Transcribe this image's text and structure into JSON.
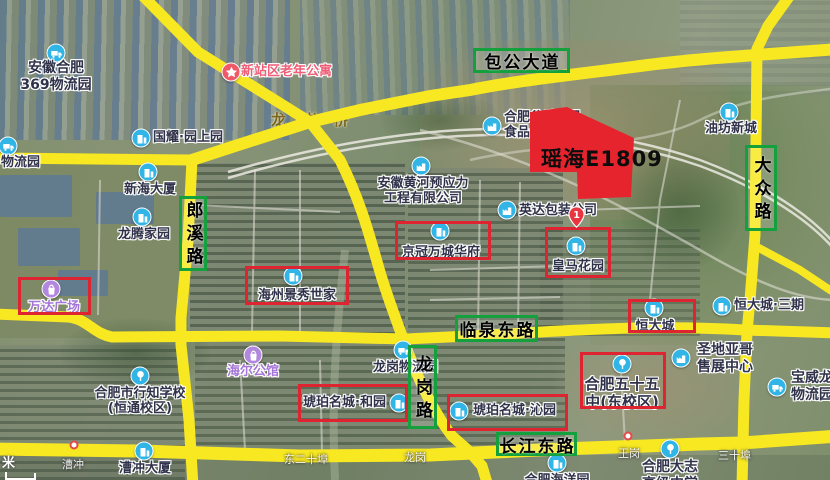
{
  "map": {
    "plot": {
      "label": "瑶海E1809",
      "fill": "#e5242e",
      "points": "530,112 567,107 634,138 631,197 578,199 577,172 530,172"
    },
    "scale_unit": "米",
    "bridge_label": "龙岗桥",
    "marker_pin": {
      "label": "1",
      "x": 568,
      "y": 206
    },
    "colors": {
      "road": "#f7e821",
      "road_label_border": "#14a03c",
      "highlight_box": "#de2430",
      "text_dark": "#30324a",
      "text_purple": "#a476d6",
      "text_pink": "#ef5d76",
      "icon_blue": "#31b4e6",
      "icon_purple": "#b288de",
      "icon_red": "#f05a68"
    },
    "road_labels": [
      {
        "id": "baogong-avenue",
        "text": "包公大道",
        "x": 473,
        "y": 48,
        "w": 97,
        "h": 25,
        "vertical": false
      },
      {
        "id": "langxi-road",
        "text": "郎溪路",
        "x": 179,
        "y": 196,
        "w": 28,
        "h": 75,
        "vertical": true
      },
      {
        "id": "dazhong-road",
        "text": "大众路",
        "x": 745,
        "y": 145,
        "w": 32,
        "h": 86,
        "vertical": true
      },
      {
        "id": "linquan-east-road",
        "text": "临泉东路",
        "x": 455,
        "y": 315,
        "w": 83,
        "h": 27,
        "vertical": false
      },
      {
        "id": "longgang-road",
        "text": "龙岗路",
        "x": 408,
        "y": 345,
        "w": 29,
        "h": 84,
        "vertical": true
      },
      {
        "id": "changjiang-east-road",
        "text": "长江东路",
        "x": 496,
        "y": 432,
        "w": 81,
        "h": 24,
        "vertical": false
      }
    ],
    "highlight_boxes": [
      {
        "id": "box-wanda",
        "x": 18,
        "y": 277,
        "w": 73,
        "h": 38
      },
      {
        "id": "box-haizhou",
        "x": 245,
        "y": 266,
        "w": 104,
        "h": 39
      },
      {
        "id": "box-jingguan",
        "x": 395,
        "y": 221,
        "w": 96,
        "h": 39
      },
      {
        "id": "box-huangma",
        "x": 545,
        "y": 227,
        "w": 66,
        "h": 51
      },
      {
        "id": "box-hengdacheng",
        "x": 628,
        "y": 299,
        "w": 68,
        "h": 34
      },
      {
        "id": "box-hupo-heyuan",
        "x": 298,
        "y": 384,
        "w": 110,
        "h": 38
      },
      {
        "id": "box-hupo-qinyuan",
        "x": 447,
        "y": 394,
        "w": 121,
        "h": 37
      },
      {
        "id": "box-no55-school",
        "x": 580,
        "y": 352,
        "w": 86,
        "h": 57
      }
    ],
    "pois": [
      {
        "id": "anhui-369-logistics",
        "lines": [
          "安徽合肥",
          "369物流园"
        ],
        "color": "dark",
        "size": 14,
        "align": "center",
        "lx": 56,
        "ly": 60,
        "icon": "truck",
        "icolor": "blue",
        "ix": 56,
        "iy": 53
      },
      {
        "id": "xinzhan-elderly-apartment",
        "lines": [
          "新站区老年公寓"
        ],
        "color": "pink",
        "size": 13,
        "align": "left",
        "lx": 241,
        "ly": 64,
        "icon": "star",
        "icolor": "red",
        "ix": 231,
        "iy": 72
      },
      {
        "id": "guoyao-yuanshangyuan",
        "lines": [
          "国耀·园上园"
        ],
        "color": "dark",
        "size": 13,
        "align": "left",
        "lx": 153,
        "ly": 130,
        "icon": "building",
        "icolor": "blue",
        "ix": 141,
        "iy": 138
      },
      {
        "id": "logistics-park-left-edge",
        "lines": [
          "物流园"
        ],
        "color": "dark",
        "size": 13,
        "align": "left",
        "lx": 1,
        "ly": 155,
        "icon": "truck",
        "icolor": "blue",
        "ix": 8,
        "iy": 146
      },
      {
        "id": "xinhai-building",
        "lines": [
          "新海大厦"
        ],
        "color": "dark",
        "size": 13,
        "align": "center",
        "lx": 150,
        "ly": 182,
        "icon": "building",
        "icolor": "blue",
        "ix": 148,
        "iy": 172
      },
      {
        "id": "longteng-homeland",
        "lines": [
          "龙腾家园"
        ],
        "color": "dark",
        "size": 13,
        "align": "center",
        "lx": 144,
        "ly": 227,
        "icon": "building",
        "icolor": "blue",
        "ix": 142,
        "iy": 217
      },
      {
        "id": "anhui-huanghe-prestress",
        "lines": [
          "安徽黄河预应力",
          "工程有限公司"
        ],
        "color": "dark",
        "size": 13,
        "align": "center",
        "lx": 423,
        "ly": 176,
        "icon": "factory",
        "icolor": "blue",
        "ix": 421,
        "iy": 166
      },
      {
        "id": "hefei-gushi-food",
        "lines": [
          "合肥谷香食品",
          "食品公司"
        ],
        "color": "dark",
        "size": 13,
        "align": "left",
        "lx": 504,
        "ly": 110,
        "icon": "factory",
        "icolor": "blue",
        "ix": 492,
        "iy": 126
      },
      {
        "id": "yingda-packaging",
        "lines": [
          "英达包装公司"
        ],
        "color": "dark",
        "size": 13,
        "align": "left",
        "lx": 519,
        "ly": 203,
        "icon": "factory",
        "icolor": "blue",
        "ix": 507,
        "iy": 210
      },
      {
        "id": "youfang-xincheng",
        "lines": [
          "油坊新城"
        ],
        "color": "dark",
        "size": 13,
        "align": "center",
        "lx": 731,
        "ly": 121,
        "icon": "building",
        "icolor": "blue",
        "ix": 729,
        "iy": 112
      },
      {
        "id": "hengdacheng-phase3",
        "lines": [
          "恒大城·三期"
        ],
        "color": "dark",
        "size": 13,
        "align": "left",
        "lx": 734,
        "ly": 298,
        "icon": "building",
        "icolor": "blue",
        "ix": 722,
        "iy": 306
      },
      {
        "id": "huangma-garden",
        "lines": [
          "皇马花园"
        ],
        "color": "dark",
        "size": 13,
        "align": "center",
        "lx": 578,
        "ly": 259,
        "icon": "building",
        "icolor": "blue",
        "ix": 576,
        "iy": 246
      },
      {
        "id": "jingguan-wancheng-huafu",
        "lines": [
          "京冠万城华府"
        ],
        "color": "dark",
        "size": 13,
        "align": "center",
        "lx": 441,
        "ly": 245,
        "icon": "building",
        "icolor": "blue",
        "ix": 440,
        "iy": 231
      },
      {
        "id": "haizhou-jingxiu-shijia",
        "lines": [
          "海州景秀世家"
        ],
        "color": "dark",
        "size": 13,
        "align": "center",
        "lx": 297,
        "ly": 288,
        "icon": "building",
        "icolor": "blue",
        "ix": 293,
        "iy": 276
      },
      {
        "id": "wanda-plaza",
        "lines": [
          "万达广场"
        ],
        "color": "purple",
        "size": 13,
        "align": "center",
        "lx": 54,
        "ly": 300,
        "icon": "bag",
        "icolor": "purple",
        "ix": 51,
        "iy": 289
      },
      {
        "id": "hengdacheng",
        "lines": [
          "恒大城"
        ],
        "color": "dark",
        "size": 13,
        "align": "center",
        "lx": 655,
        "ly": 319,
        "icon": "building",
        "icolor": "blue",
        "ix": 654,
        "iy": 308
      },
      {
        "id": "hupo-mingcheng-heyuan",
        "lines": [
          "琥珀名城·和园"
        ],
        "color": "dark",
        "size": 13,
        "align": "left",
        "lx": 303,
        "ly": 395,
        "icon": "building",
        "icolor": "blue",
        "ix": 399,
        "iy": 403
      },
      {
        "id": "hupo-mingcheng-qinyuan",
        "lines": [
          "琥珀名城·沁园"
        ],
        "color": "dark",
        "size": 13,
        "align": "left",
        "lx": 473,
        "ly": 403,
        "icon": "building",
        "icolor": "blue",
        "ix": 459,
        "iy": 411
      },
      {
        "id": "hefei-no55-middle-school",
        "lines": [
          "合肥五十五",
          "中(东校区)"
        ],
        "color": "dark",
        "size": 15,
        "align": "center",
        "lx": 622,
        "ly": 376,
        "icon": "school",
        "icolor": "blue",
        "ix": 622,
        "iy": 364
      },
      {
        "id": "shengdiyage-sales-center",
        "lines": [
          "圣地亚哥",
          "售展中心"
        ],
        "color": "dark",
        "size": 14,
        "align": "left",
        "lx": 697,
        "ly": 342,
        "icon": "factory",
        "icolor": "blue",
        "ix": 681,
        "iy": 358
      },
      {
        "id": "baoweilong-logistics",
        "lines": [
          "宝威龙志",
          "物流园"
        ],
        "color": "dark",
        "size": 14,
        "align": "left",
        "lx": 791,
        "ly": 370,
        "icon": "truck",
        "icolor": "blue",
        "ix": 777,
        "iy": 387
      },
      {
        "id": "xingzhi-school",
        "lines": [
          "合肥市行知学校",
          "(恒通校区)"
        ],
        "color": "dark",
        "size": 13,
        "align": "center",
        "lx": 140,
        "ly": 386,
        "icon": "school",
        "icolor": "blue",
        "ix": 140,
        "iy": 376
      },
      {
        "id": "haier-gongguan",
        "lines": [
          "海尔公馆"
        ],
        "color": "purple",
        "size": 13,
        "align": "center",
        "lx": 253,
        "ly": 364,
        "icon": "bag",
        "icolor": "purple",
        "ix": 253,
        "iy": 355
      },
      {
        "id": "longgang-logistics",
        "lines": [
          "龙岗物流园"
        ],
        "color": "dark",
        "size": 13,
        "align": "left",
        "lx": 373,
        "ly": 360,
        "icon": "truck",
        "icolor": "blue",
        "ix": 403,
        "iy": 350
      },
      {
        "id": "caochong-building",
        "lines": [
          "漕冲大厦"
        ],
        "color": "dark",
        "size": 13,
        "align": "center",
        "lx": 145,
        "ly": 461,
        "icon": "building",
        "icolor": "blue",
        "ix": 144,
        "iy": 451
      },
      {
        "id": "hefei-dazhi-school",
        "lines": [
          "合肥大志",
          "高级中学"
        ],
        "color": "dark",
        "size": 14,
        "align": "center",
        "lx": 670,
        "ly": 459,
        "icon": "school",
        "icolor": "blue",
        "ix": 670,
        "iy": 449
      },
      {
        "id": "hefei-haiyang-park",
        "lines": [
          "合肥海洋园"
        ],
        "color": "dark",
        "size": 13,
        "align": "center",
        "lx": 557,
        "ly": 473,
        "icon": "building",
        "icolor": "blue",
        "ix": 557,
        "iy": 463
      }
    ],
    "faint_labels": [
      {
        "id": "caochong-stop",
        "text": "漕冲",
        "x": 62,
        "y": 456
      },
      {
        "id": "wanggang-stop",
        "text": "王岗",
        "x": 618,
        "y": 445
      },
      {
        "id": "sanshibu",
        "text": "三十埠",
        "x": 718,
        "y": 447
      },
      {
        "id": "dongershibu",
        "text": "东二十埠",
        "x": 284,
        "y": 451
      },
      {
        "id": "longgang",
        "text": "龙岗",
        "x": 404,
        "y": 449
      }
    ],
    "bus_stops": [
      {
        "id": "busstop-caochong",
        "x": 74,
        "y": 445
      },
      {
        "id": "busstop-wanggang",
        "x": 628,
        "y": 436
      }
    ]
  }
}
